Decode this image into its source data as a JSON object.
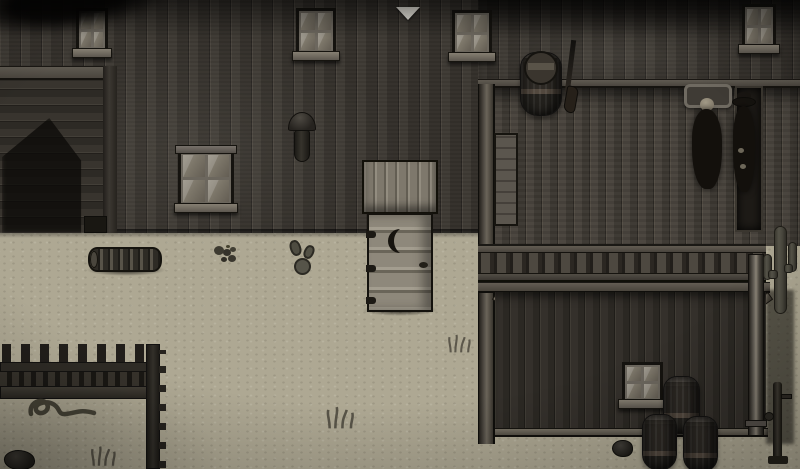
{
  "scene": {
    "description": "Top-down pixel-art western town street at dusk with wooden buildings, boardwalk, outhouse and desert props",
    "palette": {
      "sand": "#aea893",
      "wall_wood_dark": "#3a3630",
      "deck_wood": "#48433c",
      "outhouse_wood": "#9d978a",
      "window_glass": "#7b7568",
      "marker_white": "#f2efe6",
      "shadow_black": "#0d0b09"
    },
    "labels": {
      "viewport": "game viewport (click to move)",
      "marker": "event marker arrow",
      "saloon_wall": "saloon plank wall",
      "barn": "barn side with shadow",
      "window": "four-pane window",
      "lamp": "wall lamp",
      "outhouse": "outhouse with crescent moon door",
      "outhouse_door": "outhouse door",
      "boardwalk": "raised boardwalk",
      "railing": "balcony railing",
      "barrel": "wooden barrel",
      "rifle": "rifle leaning on wall",
      "crate": "crate",
      "bench": "bench",
      "npc": "villager",
      "npc_hat": "villager with hat",
      "store_door": "dark doorway",
      "keg_stack": "stacked kegs",
      "drainpipe": "corner drainpipe",
      "pump": "hand pump",
      "cactus_tall": "saguaro cactus",
      "cactus_small": "prickly pear cactus",
      "log": "fallen log",
      "shrub": "dry shrub",
      "snake": "snake",
      "fence": "dark picket fence",
      "rock": "rock",
      "grass": "grass tuft"
    }
  }
}
